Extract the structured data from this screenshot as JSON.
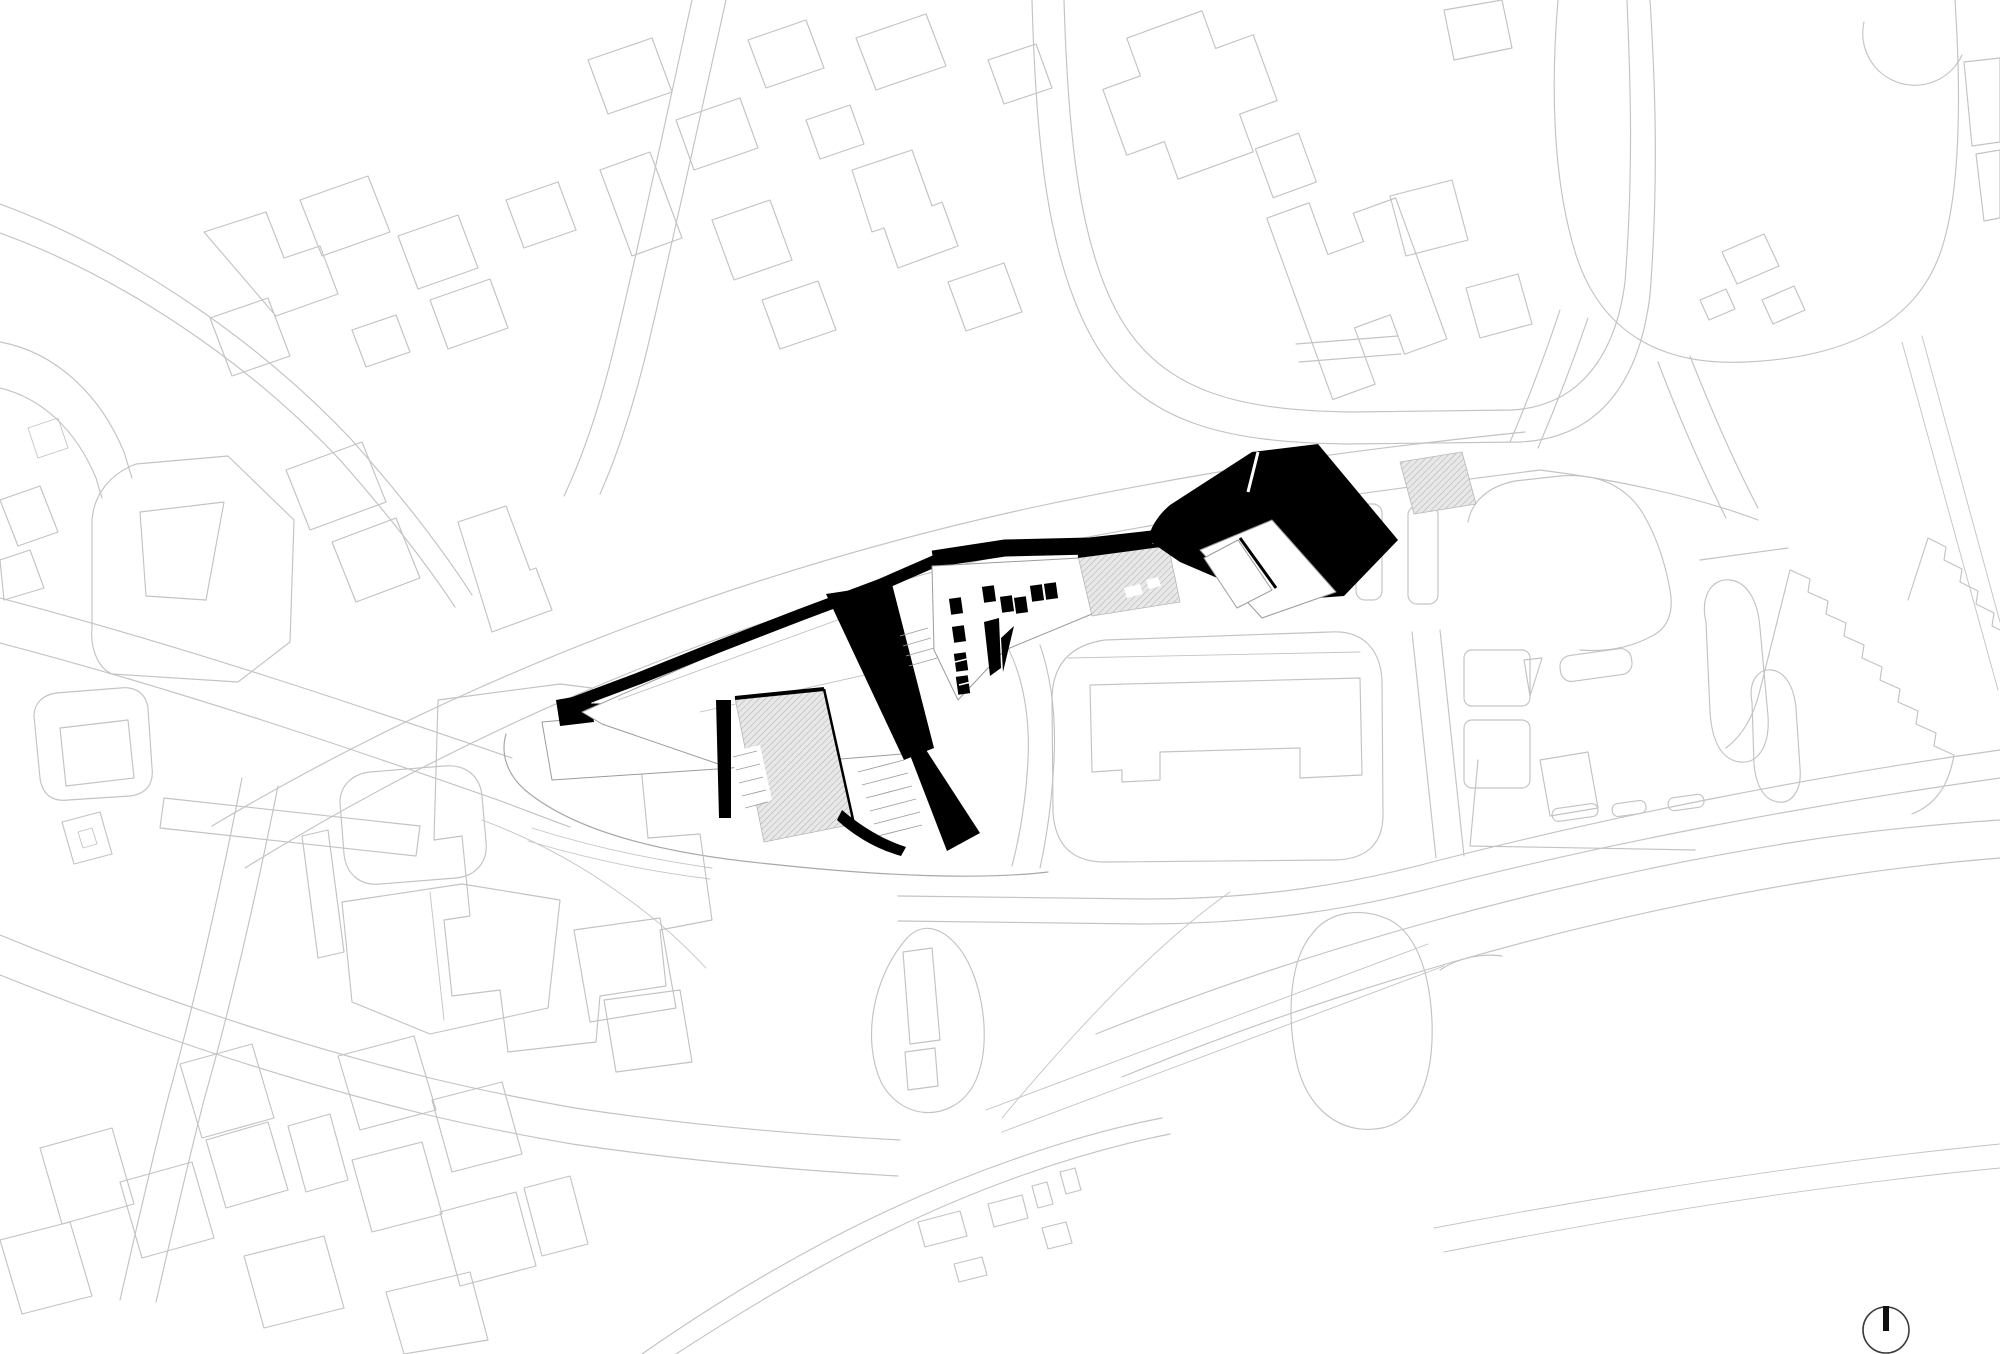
{
  "page": {
    "title": "Architectural site plan",
    "kind": "black-and-white urban site plan drawing",
    "visible_text": []
  },
  "colors": {
    "bg": "#ffffff",
    "context_line": "#c3c3c3",
    "boundary_line": "#a8a8a8",
    "project_black": "#000000",
    "roof_white": "#ffffff",
    "roof_outline": "#9b9b9b",
    "hatch_bg": "#e8e8e8",
    "hatch_line": "#b2b2b2",
    "stair_line": "#9e9e9e",
    "arrow_ring": "#3c3c3c",
    "arrow_needle": "#111111"
  },
  "layers": [
    {
      "name": "context-roads",
      "style": "light gray outline curves"
    },
    {
      "name": "context-buildings",
      "style": "light gray building footprints"
    },
    {
      "name": "project-buildings",
      "style": "solid black building masses with white roof planes and skylights"
    },
    {
      "name": "hatched-plazas",
      "style": "diagonal-hatched public plaza surfaces"
    },
    {
      "name": "north-arrow",
      "style": "circle with north needle, bottom right"
    }
  ],
  "north_arrow": {
    "name": "north-arrow",
    "direction": "up"
  }
}
